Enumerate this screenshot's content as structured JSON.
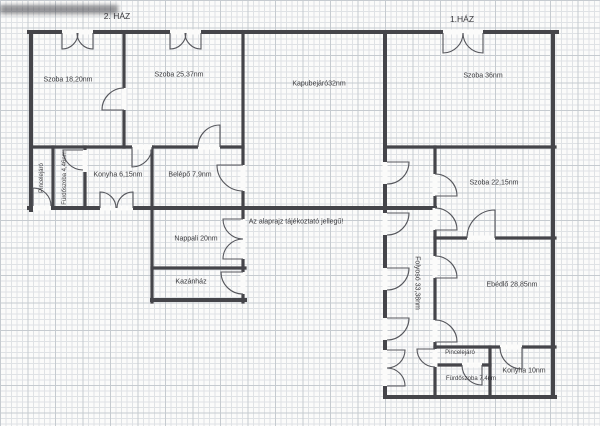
{
  "colors": {
    "ink": "#45454a",
    "door": "#55565c",
    "grid_minor": "#dfe2e5",
    "grid_major": "#c6cbd0",
    "paper": "#fbfbfa",
    "label": "#3a3a3e"
  },
  "disclaimer": "Az alaprajz tájékoztató jellegű!",
  "house2": {
    "title": "2. HÁZ",
    "rooms": {
      "szoba_18": "Szoba 18,20nm",
      "szoba_25": "Szoba 25,37nm",
      "kapubejaro": "Kapubejáró32nm",
      "pincelejaro": "Pincelejáró",
      "furdoszoba": "Fürdőszoba 4,46nm",
      "konyha": "Konyha 6,15nm",
      "belepo": "Belépő 7,9nm",
      "nappali": "Nappali 20nm",
      "kazanhaz": "Kazánház"
    }
  },
  "house1": {
    "title": "1.HÁZ",
    "rooms": {
      "szoba_36": "Szoba 36nm",
      "szoba_22": "Szoba 22,15nm",
      "folyoso": "Folyosó 33,38nm",
      "ebedlo": "Ebédlő 28,85nm",
      "pincelejaro": "Pincelejáró",
      "furdoszoba": "Fürdőszoba 7,4nm",
      "konyha": "Konyha 10nm"
    }
  }
}
